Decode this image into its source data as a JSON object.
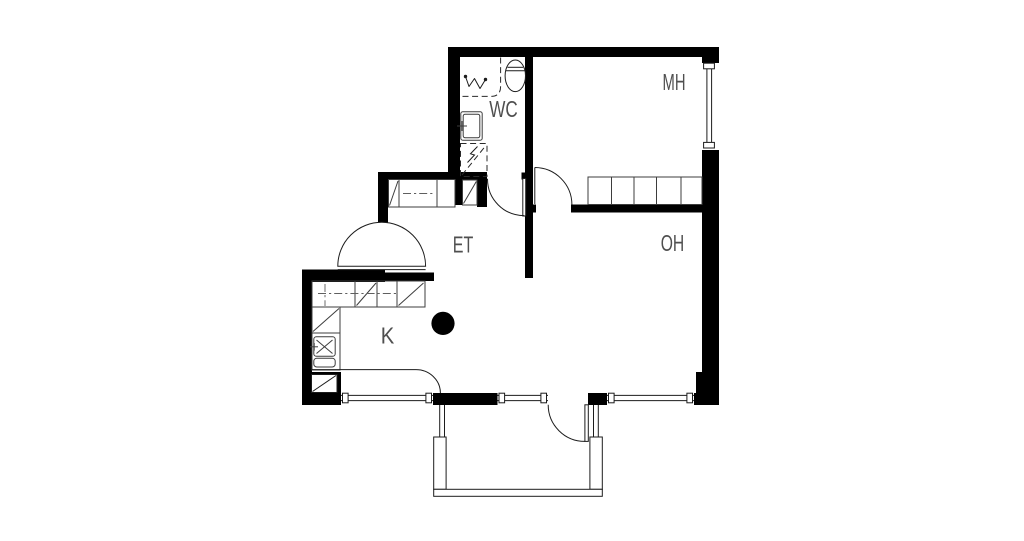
{
  "rooms": {
    "wc": "WC",
    "mh": "MH",
    "et": "ET",
    "oh": "OH",
    "k": "K"
  },
  "colors": {
    "background": "#ffffff",
    "walls": "#000000",
    "linework": "#1c1c1c",
    "labels": "#4f4f4f"
  }
}
